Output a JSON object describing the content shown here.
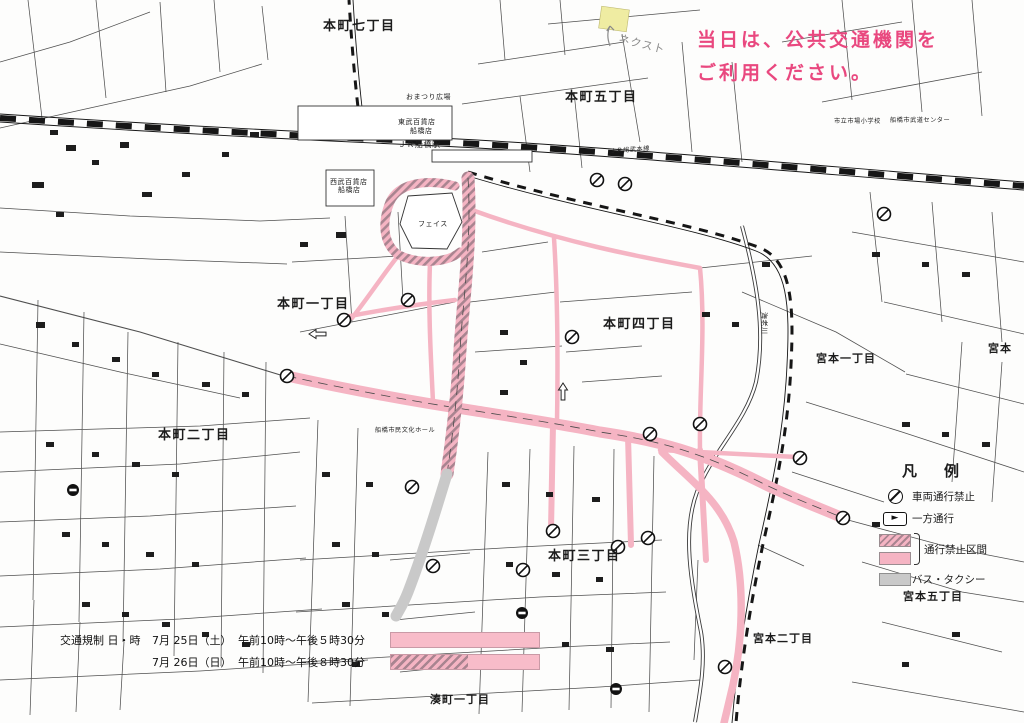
{
  "notice": {
    "line1": "当日は、公共交通機関を",
    "line2": "ご利用ください。"
  },
  "colors": {
    "notice_pink": "#e9487f",
    "route_pink": "#f5b4c3",
    "route_hatch": "#a98490",
    "bus_gray": "#c9c9c9",
    "note_yellow": "#efeca2"
  },
  "legend": {
    "title": "凡　例",
    "items": [
      {
        "icon": "no-entry-icon",
        "label": "車両通行禁止"
      },
      {
        "icon": "one-way-arrow-icon",
        "label": "一方通行"
      },
      {
        "icon": "prohibited-swatches",
        "label": "通行禁止区間"
      },
      {
        "icon": "bus-taxi-swatch",
        "label": "バス・タクシー"
      }
    ]
  },
  "schedule": {
    "title": "交通規制 日・時",
    "rows": [
      {
        "date": "7月 25日（土）",
        "time": "午前10時～午後５時30分",
        "bar": "solid-pink"
      },
      {
        "date": "7月 26日（日）",
        "time": "午前10時～午後８時30分",
        "bar": "hatched-then-pink"
      }
    ]
  },
  "note": {
    "text": "ネクスト"
  },
  "map": {
    "districts": [
      {
        "name": "本町七丁目"
      },
      {
        "name": "本町五丁目"
      },
      {
        "name": "本町一丁目"
      },
      {
        "name": "本町四丁目"
      },
      {
        "name": "本町二丁目"
      },
      {
        "name": "本町三丁目"
      },
      {
        "name": "宮本一丁目"
      },
      {
        "name": "宮本"
      },
      {
        "name": "宮本五丁目"
      },
      {
        "name": "宮本二丁目"
      },
      {
        "name": "湊町一丁目"
      }
    ],
    "places": [
      {
        "name": "東武百貨店"
      },
      {
        "name": "船橋店"
      },
      {
        "name": "ＪＲ船橋駅"
      },
      {
        "name": "西武百貨店"
      },
      {
        "name": "船橋店"
      },
      {
        "name": "フェイス"
      },
      {
        "name": "おまつり広場"
      },
      {
        "name": "市立市場小学校"
      },
      {
        "name": "船橋市武道センター"
      },
      {
        "name": "船橋市民文化ホール"
      }
    ],
    "rail_label": "ＪＲ総武本線",
    "river_label": "海老川"
  }
}
